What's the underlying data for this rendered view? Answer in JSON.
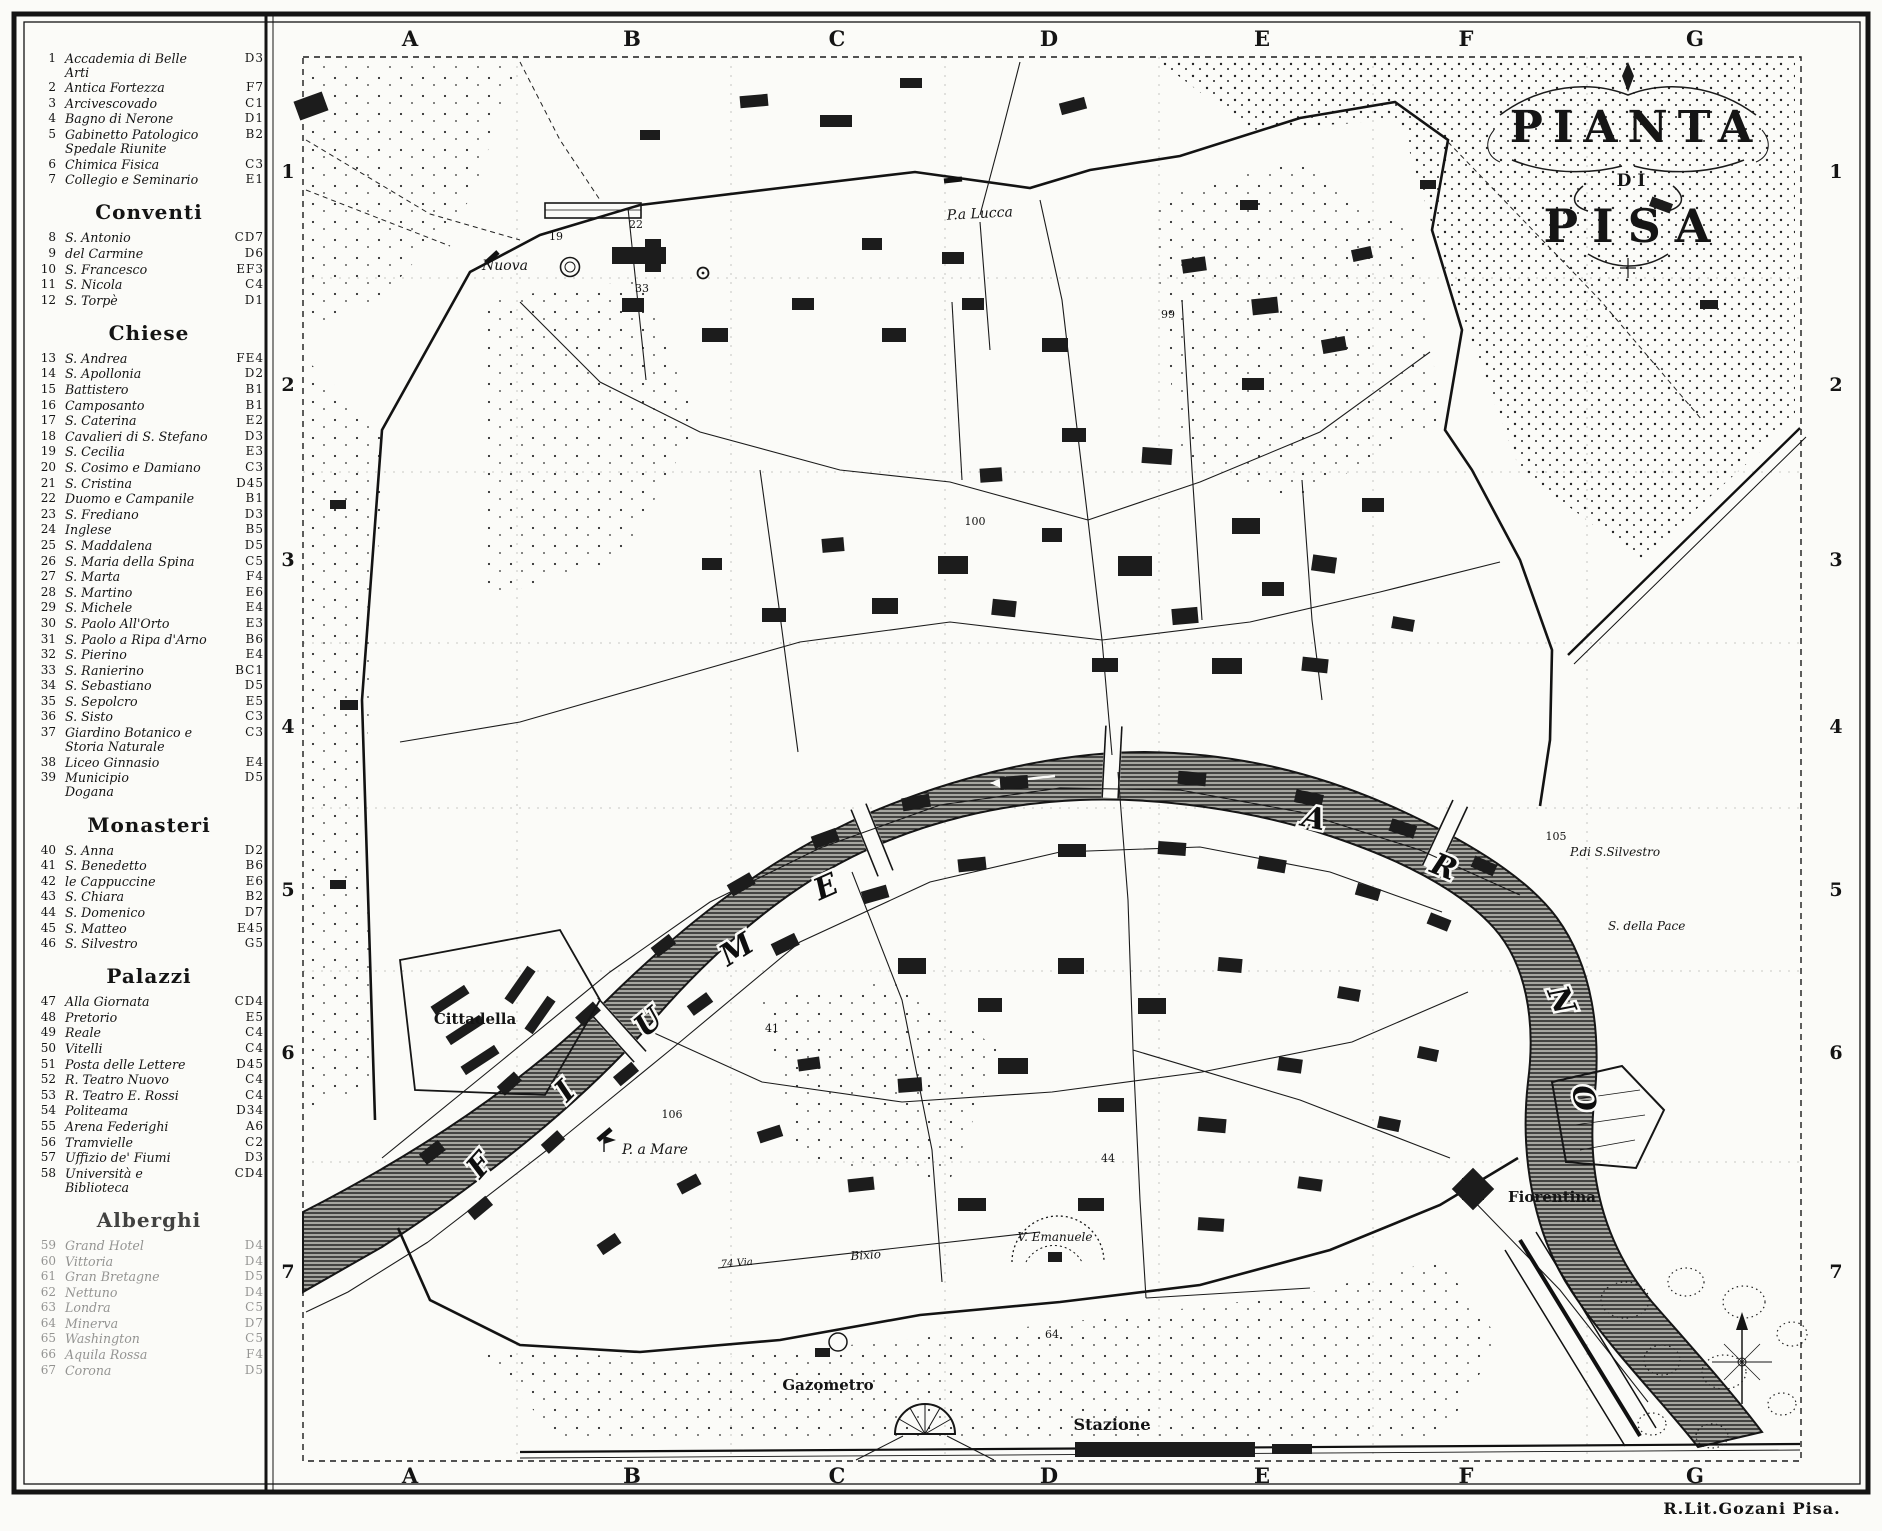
{
  "title": {
    "line1": "PIANTA",
    "line2": "DI",
    "line3": "PISA"
  },
  "credit": "R.Lit.Gozani Pisa.",
  "grid": {
    "letters": [
      "A",
      "B",
      "C",
      "D",
      "E",
      "F",
      "G"
    ],
    "numbers": [
      "1",
      "2",
      "3",
      "4",
      "5",
      "6",
      "7"
    ]
  },
  "legend": {
    "sections": [
      {
        "title": "",
        "items": [
          {
            "n": "1",
            "name": "Accademia di Belle\nArti",
            "code": "D3"
          },
          {
            "n": "2",
            "name": "Antica Fortezza",
            "code": "F7"
          },
          {
            "n": "3",
            "name": "Arcivescovado",
            "code": "C1"
          },
          {
            "n": "4",
            "name": "Bagno di Nerone",
            "code": "D1"
          },
          {
            "n": "5",
            "name": "Gabinetto Patologico\nSpedale Riunite",
            "code": "B2"
          },
          {
            "n": "6",
            "name": "Chimica Fisica",
            "code": "C3"
          },
          {
            "n": "7",
            "name": "Collegio e Seminario",
            "code": "E1"
          }
        ]
      },
      {
        "title": "Conventi",
        "items": [
          {
            "n": "8",
            "name": "S. Antonio",
            "code": "CD7"
          },
          {
            "n": "9",
            "name": "del Carmine",
            "code": "D6"
          },
          {
            "n": "10",
            "name": "S. Francesco",
            "code": "EF3"
          },
          {
            "n": "11",
            "name": "S. Nicola",
            "code": "C4"
          },
          {
            "n": "12",
            "name": "S. Torpè",
            "code": "D1"
          }
        ]
      },
      {
        "title": "Chiese",
        "items": [
          {
            "n": "13",
            "name": "S. Andrea",
            "code": "FE4"
          },
          {
            "n": "14",
            "name": "S. Apollonia",
            "code": "D2"
          },
          {
            "n": "15",
            "name": "Battistero",
            "code": "B1"
          },
          {
            "n": "16",
            "name": "Camposanto",
            "code": "B1"
          },
          {
            "n": "17",
            "name": "S. Caterina",
            "code": "E2"
          },
          {
            "n": "18",
            "name": "Cavalieri di S. Stefano",
            "code": "D3"
          },
          {
            "n": "19",
            "name": "S. Cecilia",
            "code": "E3"
          },
          {
            "n": "20",
            "name": "S. Cosimo e Damiano",
            "code": "C3"
          },
          {
            "n": "21",
            "name": "S. Cristina",
            "code": "D45"
          },
          {
            "n": "22",
            "name": "Duomo e Campanile",
            "code": "B1"
          },
          {
            "n": "23",
            "name": "S. Frediano",
            "code": "D3"
          },
          {
            "n": "24",
            "name": "Inglese",
            "code": "B5"
          },
          {
            "n": "25",
            "name": "S. Maddalena",
            "code": "D5"
          },
          {
            "n": "26",
            "name": "S. Maria della Spina",
            "code": "C5"
          },
          {
            "n": "27",
            "name": "S. Marta",
            "code": "F4"
          },
          {
            "n": "28",
            "name": "S. Martino",
            "code": "E6"
          },
          {
            "n": "29",
            "name": "S. Michele",
            "code": "E4"
          },
          {
            "n": "30",
            "name": "S. Paolo All'Orto",
            "code": "E3"
          },
          {
            "n": "31",
            "name": "S. Paolo a Ripa d'Arno",
            "code": "B6"
          },
          {
            "n": "32",
            "name": "S. Pierino",
            "code": "E4"
          },
          {
            "n": "33",
            "name": "S. Ranierino",
            "code": "BC1"
          },
          {
            "n": "34",
            "name": "S. Sebastiano",
            "code": "D5"
          },
          {
            "n": "35",
            "name": "S. Sepolcro",
            "code": "E5"
          },
          {
            "n": "36",
            "name": "S. Sisto",
            "code": "C3"
          },
          {
            "n": "37",
            "name": "Giardino Botanico e\nStoria Naturale",
            "code": "C3"
          },
          {
            "n": "38",
            "name": "Liceo Ginnasio",
            "code": "E4"
          },
          {
            "n": "39",
            "name": "Municipio\nDogana",
            "code": "D5"
          }
        ]
      },
      {
        "title": "Monasteri",
        "items": [
          {
            "n": "40",
            "name": "S. Anna",
            "code": "D2"
          },
          {
            "n": "41",
            "name": "S. Benedetto",
            "code": "B6"
          },
          {
            "n": "42",
            "name": "le Cappuccine",
            "code": "E6"
          },
          {
            "n": "43",
            "name": "S. Chiara",
            "code": "B2"
          },
          {
            "n": "44",
            "name": "S. Domenico",
            "code": "D7"
          },
          {
            "n": "45",
            "name": "S. Matteo",
            "code": "E45"
          },
          {
            "n": "46",
            "name": "S. Silvestro",
            "code": "G5"
          }
        ]
      },
      {
        "title": "Palazzi",
        "items": [
          {
            "n": "47",
            "name": "Alla Giornata",
            "code": "CD4"
          },
          {
            "n": "48",
            "name": "Pretorio",
            "code": "E5"
          },
          {
            "n": "49",
            "name": "Reale",
            "code": "C4"
          },
          {
            "n": "50",
            "name": "Vitelli",
            "code": "C4"
          },
          {
            "n": "51",
            "name": "Posta delle Lettere",
            "code": "D45"
          },
          {
            "n": "52",
            "name": "R. Teatro Nuovo",
            "code": "C4"
          },
          {
            "n": "53",
            "name": "R. Teatro E. Rossi",
            "code": "C4"
          },
          {
            "n": "54",
            "name": "Politeama",
            "code": "D34"
          },
          {
            "n": "55",
            "name": "Arena Federighi",
            "code": "A6"
          },
          {
            "n": "56",
            "name": "Tramvielle",
            "code": "C2"
          },
          {
            "n": "57",
            "name": "Uffizio de' Fiumi",
            "code": "D3"
          },
          {
            "n": "58",
            "name": "Università e\nBiblioteca",
            "code": "CD4"
          }
        ]
      },
      {
        "title": "Alberghi",
        "items": [
          {
            "n": "59",
            "name": "Grand Hotel",
            "code": "D4"
          },
          {
            "n": "60",
            "name": "Vittoria",
            "code": "D4"
          },
          {
            "n": "61",
            "name": "Gran Bretagne",
            "code": "D5"
          },
          {
            "n": "62",
            "name": "Nettuno",
            "code": "D4"
          },
          {
            "n": "63",
            "name": "Londra",
            "code": "C5"
          },
          {
            "n": "64",
            "name": "Minerva",
            "code": "D7"
          },
          {
            "n": "65",
            "name": "Washington",
            "code": "C5"
          },
          {
            "n": "66",
            "name": "Aquila Rossa",
            "code": "F4"
          },
          {
            "n": "67",
            "name": "Corona",
            "code": "D5"
          }
        ]
      }
    ]
  },
  "map": {
    "labels": {
      "pa_lucca": "P.a Lucca",
      "nuova": "Nuova",
      "cittadella": "Cittadella",
      "p_a_mare": "P. a Mare",
      "v_emanuele": "V. Emanuele",
      "bixio": "Bixio",
      "via74": "74 Via",
      "gazometro": "Gazometro",
      "stazione": "Stazione",
      "fiorentina": "Fiorentina",
      "n105": "105",
      "p_s_silvestro": "P.di S.Silvestro",
      "s_della_pace": "S. della Pace"
    },
    "river": {
      "fiume_letters": [
        "F",
        "I",
        "U",
        "M",
        "E"
      ],
      "arno_letters": [
        "A",
        "R",
        "N",
        "O"
      ]
    },
    "numbers": [
      {
        "t": "106",
        "x": 672,
        "y": 1118
      },
      {
        "t": "100",
        "x": 975,
        "y": 525
      },
      {
        "t": "99",
        "x": 1168,
        "y": 318
      },
      {
        "t": "22",
        "x": 636,
        "y": 228
      },
      {
        "t": "19",
        "x": 556,
        "y": 240
      },
      {
        "t": "33",
        "x": 642,
        "y": 292
      },
      {
        "t": "44",
        "x": 1108,
        "y": 1162
      },
      {
        "t": "41",
        "x": 772,
        "y": 1032
      },
      {
        "t": "64",
        "x": 1052,
        "y": 1338
      }
    ]
  }
}
